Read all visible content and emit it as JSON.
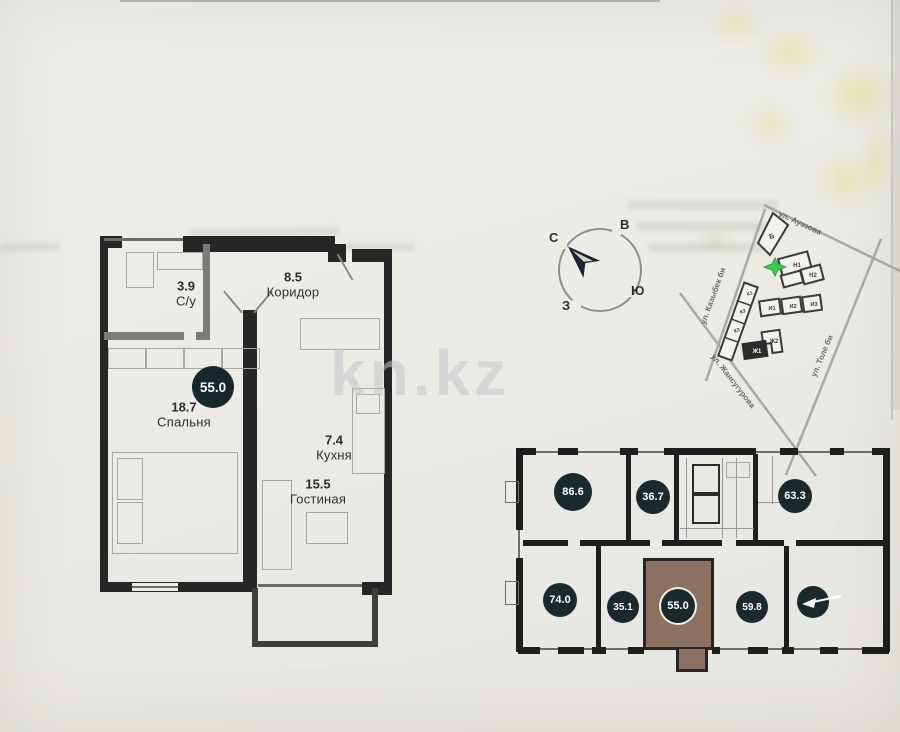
{
  "watermark": {
    "text": "kn.kz"
  },
  "apartment_plan": {
    "total_area": "55.0",
    "rooms": {
      "bathroom": {
        "area": "3.9",
        "name": "С/у"
      },
      "corridor": {
        "area": "8.5",
        "name": "Коридор"
      },
      "bedroom": {
        "area": "18.7",
        "name": "Спальня"
      },
      "kitchen": {
        "area": "7.4",
        "name": "Кухня"
      },
      "living_room": {
        "area": "15.5",
        "name": "Гостиная"
      }
    }
  },
  "compass": {
    "north": "С",
    "east": "В",
    "south": "Ю",
    "west": "З"
  },
  "site_map": {
    "streets": {
      "auezova": "ул. Ауэзова",
      "kazybek_bi": "ул. Казыбек би",
      "tole_bi": "ул. Толе би",
      "zhansugurova": "ул. Жансугурова"
    },
    "buildings": {
      "b": "Б",
      "n1": "Н1",
      "n2": "Н2",
      "i1": "И1",
      "i2": "И2",
      "i3": "И3",
      "k1": "К1",
      "k2": "К2",
      "k3": "К3",
      "zh1": "Ж1",
      "zh2": "Ж2"
    },
    "marker_color": "#3ecb55"
  },
  "floor_layout": {
    "units": [
      {
        "area": "86.6"
      },
      {
        "area": "36.7"
      },
      {
        "area": "63.3"
      },
      {
        "area": "74.0"
      },
      {
        "area": "35.1"
      },
      {
        "area": "55.0",
        "highlighted": true
      },
      {
        "area": "59.8"
      }
    ],
    "highlight_color": "#8c7162",
    "badge_color": "#1a292c"
  }
}
